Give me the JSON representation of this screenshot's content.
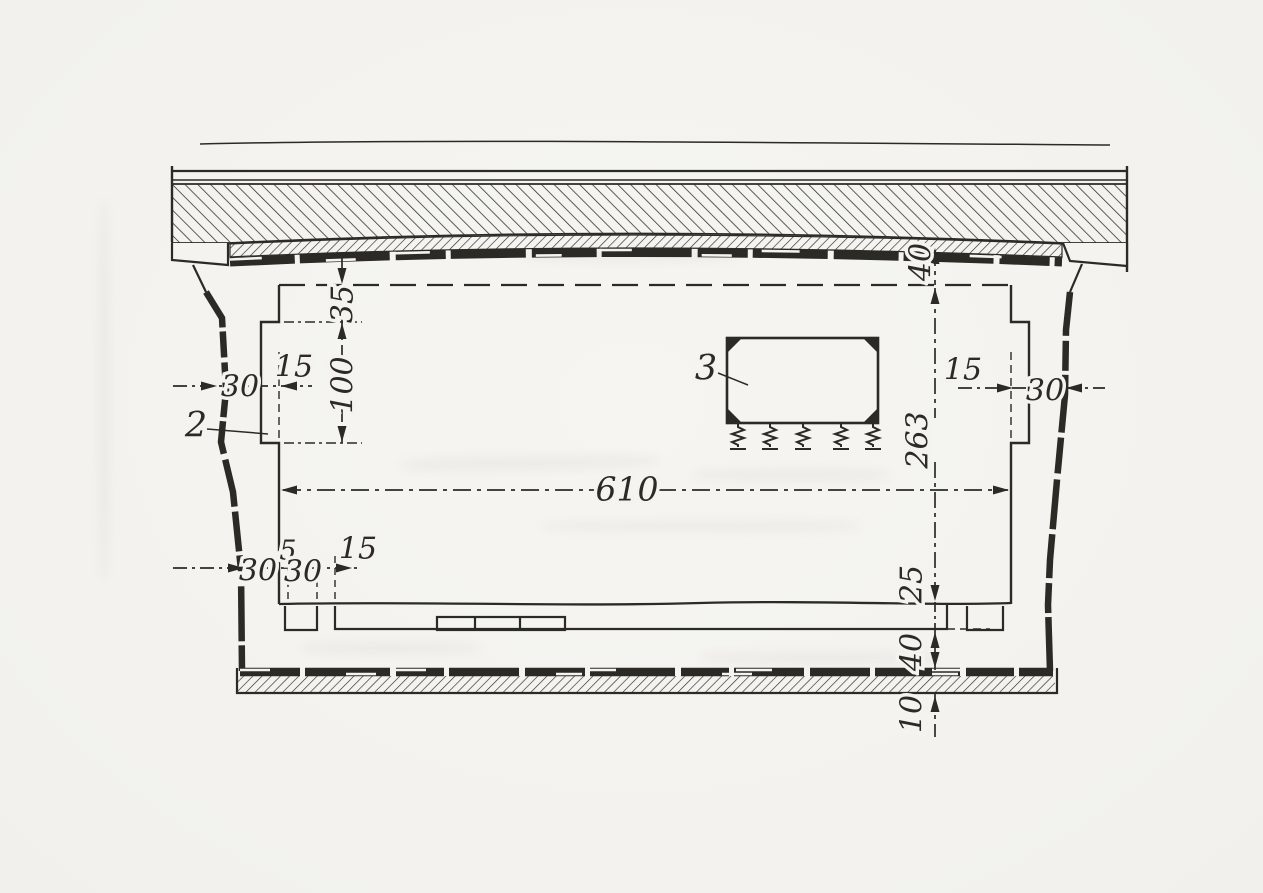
{
  "drawing": {
    "callouts": {
      "wall_lining": "2",
      "machine": "3"
    },
    "dims": {
      "roof_slab_thickness": "40",
      "recess_top_offset": "35",
      "recess_height": "100",
      "recess_depth_left": "15",
      "left_wall_thickness": "30",
      "interior_height": "263",
      "interior_width": "610",
      "recess_depth_right": "15",
      "right_wall_thickness": "30",
      "left_wall_lower": "30",
      "plinth_gap": "5",
      "plinth_width": "30",
      "plinth_offset": "15",
      "floor_slab": "25",
      "underfloor_space": "40",
      "base_layer": "10"
    },
    "colors": {
      "ink": "#2c2a25",
      "paper": "#f4f3ef"
    }
  }
}
